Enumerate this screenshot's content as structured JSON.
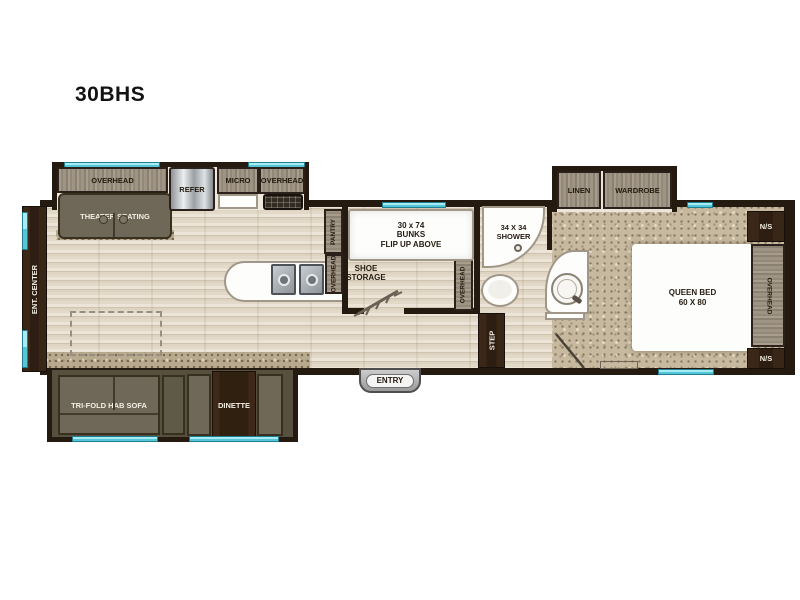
{
  "title": "30BHS",
  "front": {
    "ent_center": "ENT. CENTER"
  },
  "kitchen_slide": {
    "overhead_left": "OVERHEAD",
    "theater_seating": "THEATER SEATING",
    "refer": "REFER",
    "micro": "MICRO",
    "overhead_right": "OVERHEAD"
  },
  "kitchen": {
    "pantry": "PANTRY",
    "overhead": "OVERHEAD"
  },
  "bunk_room": {
    "bunk_line1": "30 x 74",
    "bunk_line2": "BUNKS",
    "bunk_line3": "FLIP UP ABOVE",
    "shoe_line1": "SHOE",
    "shoe_line2": "STORAGE",
    "overhead": "OVERHEAD"
  },
  "bathroom": {
    "shower_line1": "34 X 34",
    "shower_line2": "SHOWER",
    "step": "STEP"
  },
  "bedroom_slide": {
    "linen": "LINEN",
    "wardrobe": "WARDROBE"
  },
  "bedroom": {
    "bed_line1": "QUEEN BED",
    "bed_line2": "60 X 80",
    "ns_top": "N/S",
    "ns_bottom": "N/S",
    "overhead": "OVERHEAD"
  },
  "living_slide": {
    "sofa": "TRI-FOLD HAB SOFA",
    "dinette": "DINETTE"
  },
  "entry_label": "ENTRY",
  "colors": {
    "wall": "#241a10",
    "window": "#55c6d8",
    "wood_floor": "#e3d9c8",
    "carpet": "#c6b99f",
    "cabinet_wood": "#9c9183",
    "dark_brown": "#35241a",
    "upholstery": "#6f6858"
  }
}
